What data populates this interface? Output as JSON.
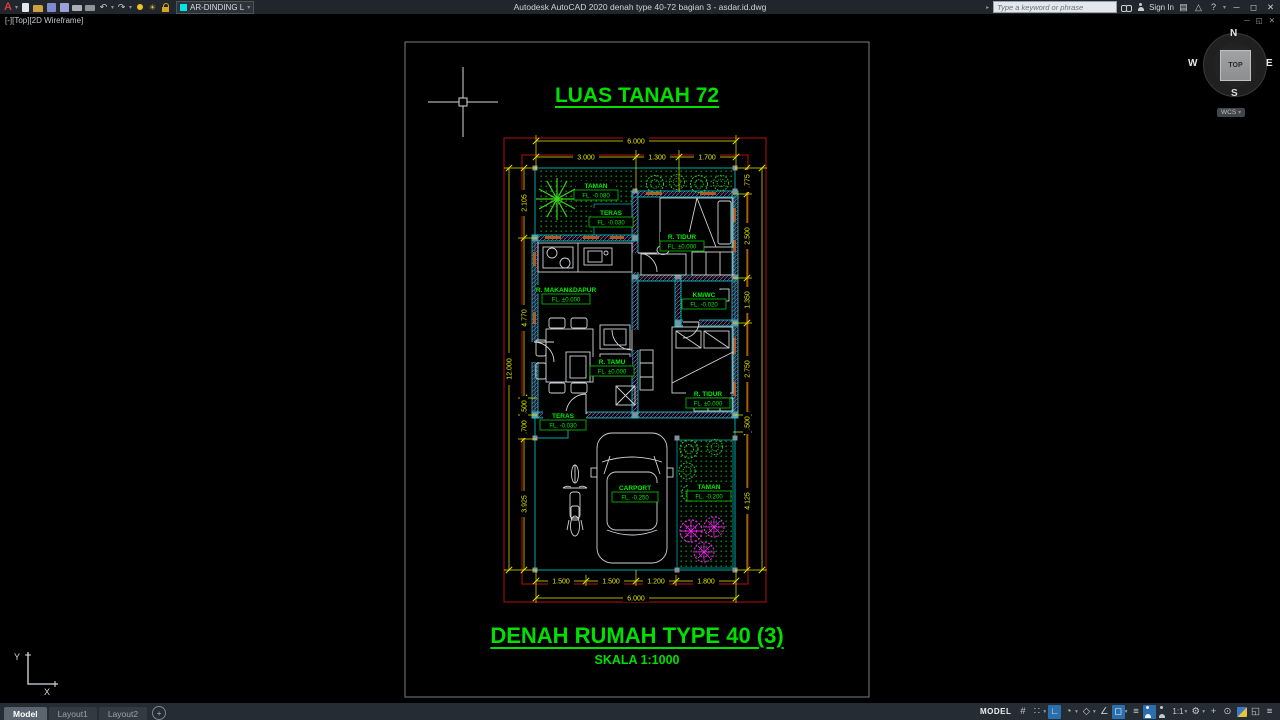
{
  "window": {
    "title": "Autodesk AutoCAD 2020   denah type 40-72 bagian 3 - asdar.id.dwg"
  },
  "topbar": {
    "layer_name": "AR-DINDING L",
    "search_placeholder": "Type a keyword or phrase",
    "sign_in_label": "Sign In"
  },
  "viewport": {
    "controls_label": "[-][Top][2D Wireframe]"
  },
  "viewcube": {
    "north": "N",
    "south": "S",
    "west": "W",
    "east": "E",
    "face": "TOP",
    "wcs_label": "WCS"
  },
  "ucs": {
    "x_label": "X",
    "y_label": "Y"
  },
  "drawing": {
    "top_title": "LUAS TANAH 72",
    "bottom_title": "DENAH RUMAH TYPE 40 (3)",
    "scale_label": "SKALA 1:1000",
    "dims": {
      "top_overall": "6.000",
      "top": [
        "3.000",
        "1.300",
        "1.700"
      ],
      "bottom": [
        "1.500",
        "1.500",
        "1.200",
        "1.800"
      ],
      "bottom_overall": "6.000",
      "left": [
        "2.105",
        "4.770",
        ".500",
        ".700",
        "3.925"
      ],
      "left_overall": "12.000",
      "right": [
        ".775",
        "2.500",
        "1.350",
        "2.750",
        ".500",
        "4.125"
      ],
      "right_overall": "12.000"
    },
    "rooms": [
      {
        "name": "TAMAN",
        "level": "FL. -0.080"
      },
      {
        "name": "TERAS",
        "level": "FL. -0.030"
      },
      {
        "name": "R. TIDUR",
        "level": "FL. ±0.000"
      },
      {
        "name": "KM/WC",
        "level": "FL. -0.020"
      },
      {
        "name": "R. MAKAN&DAPUR",
        "level": "FL. ±0.000"
      },
      {
        "name": "R. TAMU",
        "level": "FL. ±0.000"
      },
      {
        "name": "R. TIDUR",
        "level": "FL. ±0.000"
      },
      {
        "name": "TERAS",
        "level": "FL. -0.030"
      },
      {
        "name": "CARPORT",
        "level": "FL. -0.250"
      },
      {
        "name": "TAMAN",
        "level": "FL. -0.200"
      }
    ]
  },
  "statusbar": {
    "tabs": [
      "Model",
      "Layout1",
      "Layout2"
    ],
    "model_label": "MODEL",
    "annotation_scale": "1:1"
  }
}
